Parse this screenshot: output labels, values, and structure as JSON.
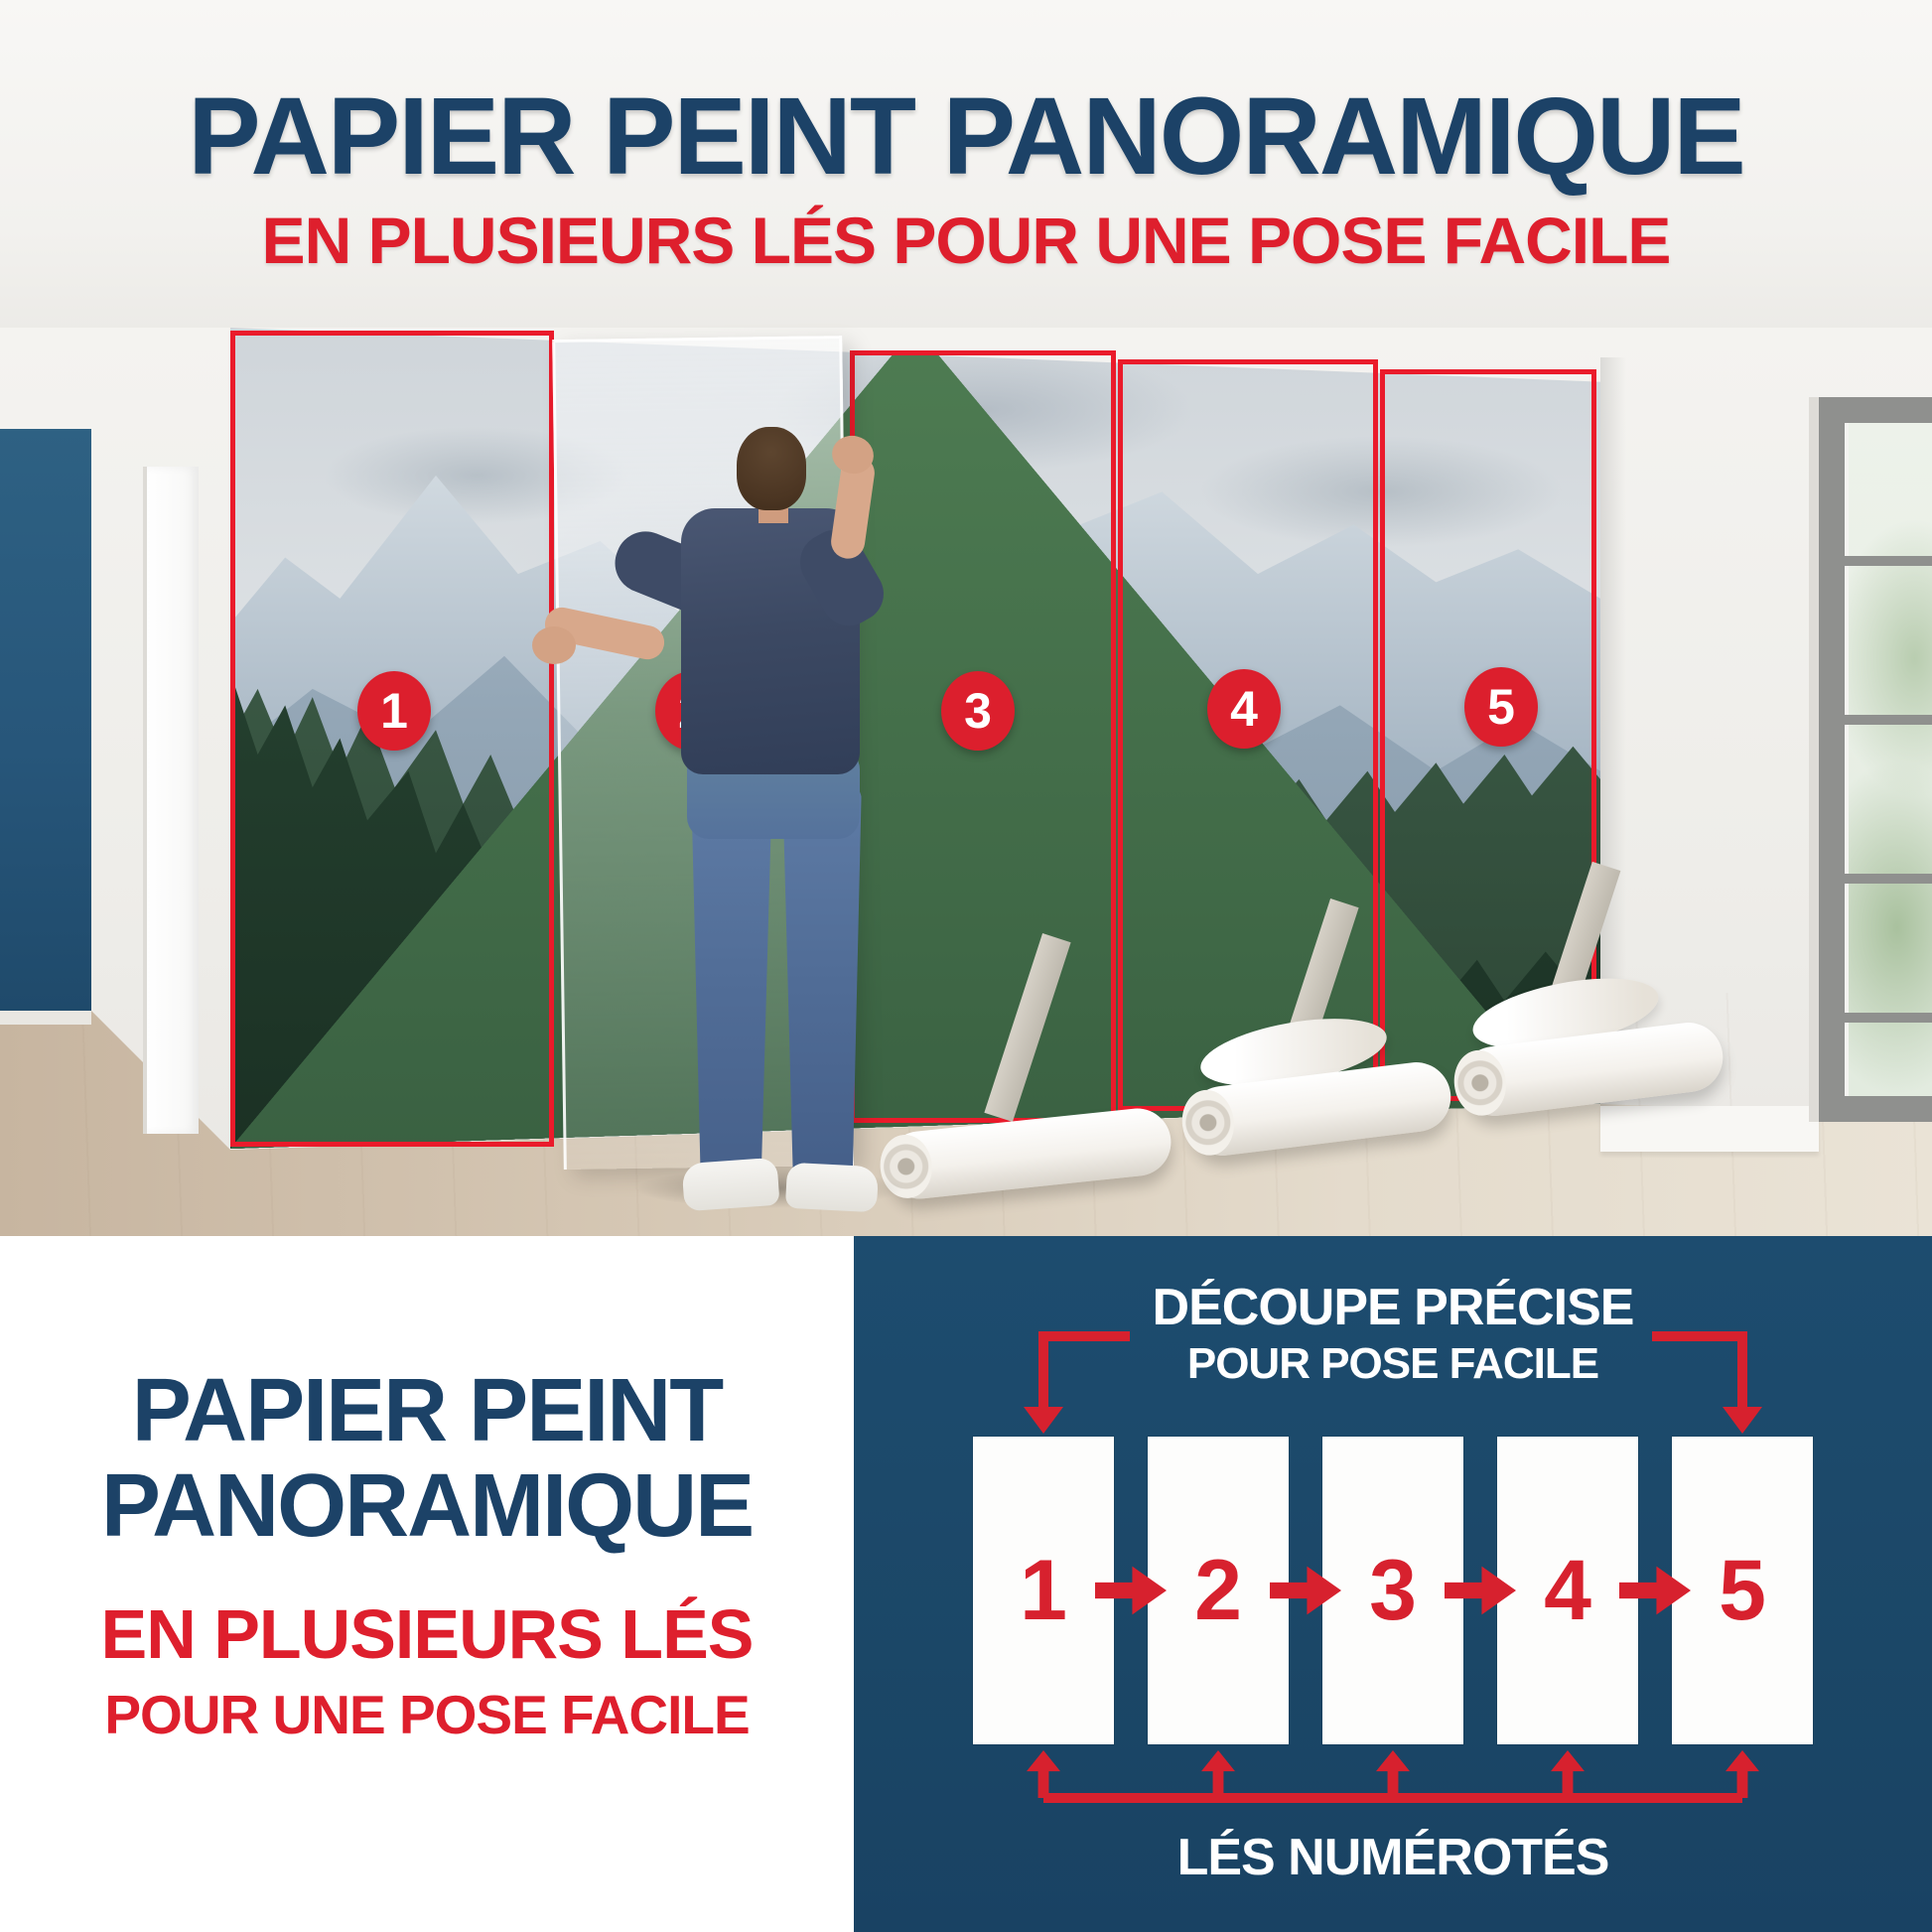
{
  "header": {
    "title": "PAPIER PEINT PANORAMIQUE",
    "subtitle": "EN PLUSIEURS LÉS POUR UNE POSE FACILE"
  },
  "photo": {
    "description": "Homme posant un papier peint panoramique montagne et forêt en 5 lés numérotés",
    "panels": [
      "1",
      "2",
      "3",
      "4",
      "5"
    ]
  },
  "bottom_left": {
    "title_line1": "PAPIER PEINT",
    "title_line2": "PANORAMIQUE",
    "subtitle_line1": "EN PLUSIEURS LÉS",
    "subtitle_line2": "POUR UNE POSE FACILE"
  },
  "bottom_right": {
    "heading_line1": "DÉCOUPE PRÉCISE",
    "heading_line2": "POUR POSE FACILE",
    "numbers": [
      "1",
      "2",
      "3",
      "4",
      "5"
    ],
    "caption": "LÉS NUMÉROTÉS"
  },
  "icons": {
    "arrow_down": "arrow-down-icon",
    "arrow_right": "arrow-right-icon",
    "arrow_up": "arrow-up-icon"
  },
  "colors": {
    "navy_background": "#1b4767",
    "navy_text": "#1c4267",
    "red": "#de1f2d",
    "red_outline": "#ea1b2b",
    "accent_wall": "#27567a",
    "white": "#ffffff"
  }
}
